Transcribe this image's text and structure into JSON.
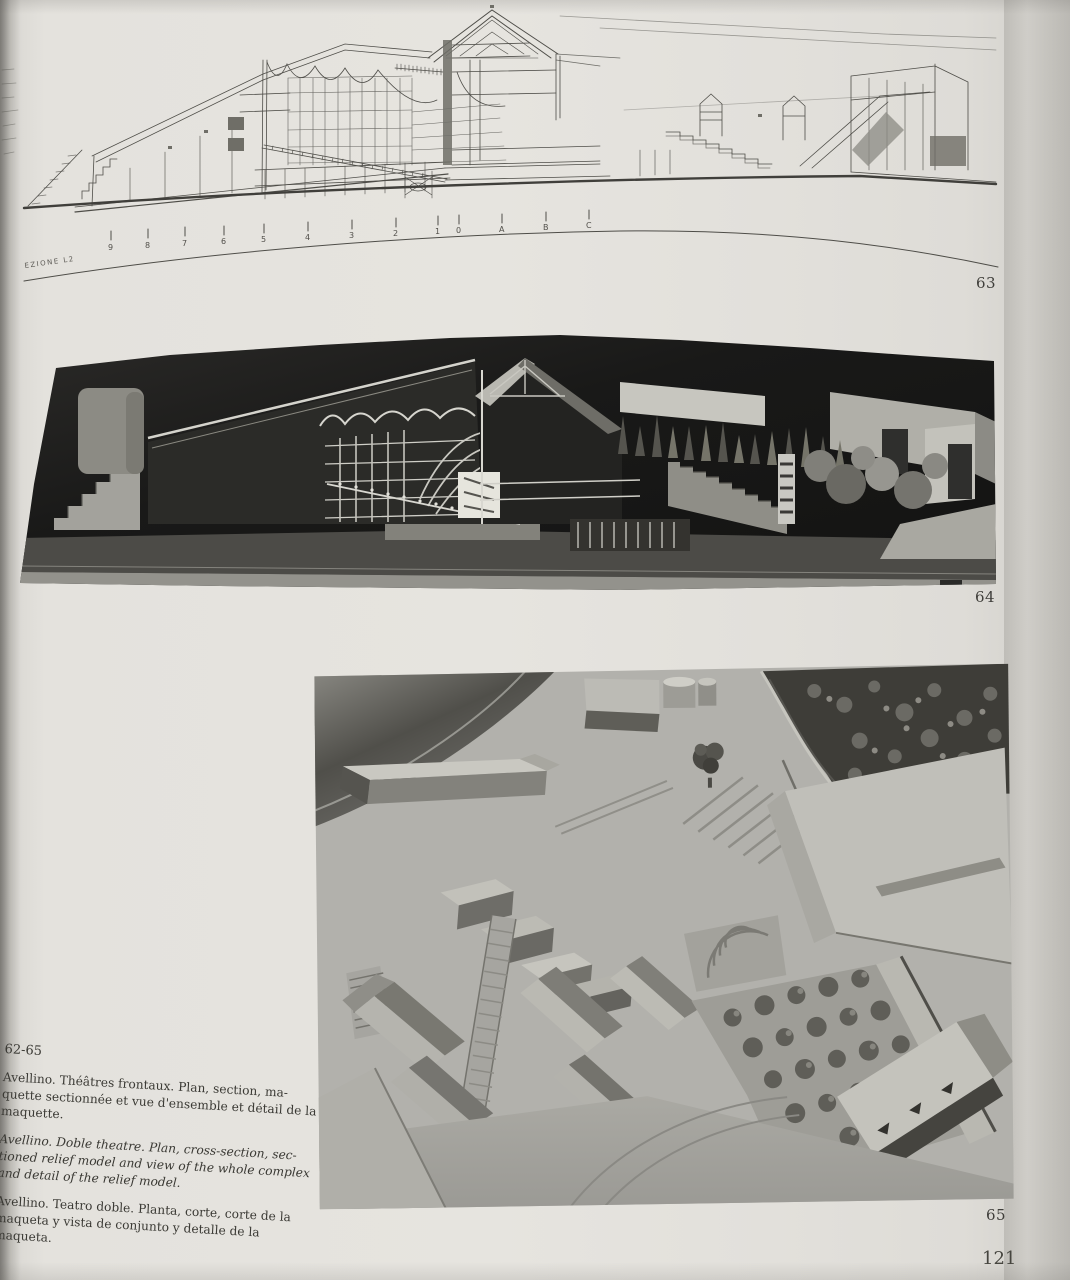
{
  "figures": {
    "fig63": "63",
    "fig64": "64",
    "fig65": "65"
  },
  "page_number": "121",
  "drawing": {
    "section_label": "EZIONE  L2",
    "scale_labels": [
      "9",
      "8",
      "7",
      "6",
      "5",
      "4",
      "3",
      "2",
      "1",
      "0",
      "A",
      "B",
      "C"
    ]
  },
  "captions": {
    "range": "62-65",
    "french": [
      "Avellino. Théâtres frontaux. Plan, section, ma-",
      "quette sectionnée et vue d'ensemble et détail de la",
      "maquette."
    ],
    "english": [
      "Avellino. Doble theatre. Plan, cross-section, sec-",
      "tioned relief model and view of the whole complex",
      "and detail of the relief model."
    ],
    "spanish": [
      "Avellino. Teatro doble. Planta, corte, corte de la",
      "maqueta y vista de conjunto y detalle de la",
      "maqueta."
    ]
  },
  "colors": {
    "paper": "#e4e2dd",
    "ink_line": "#4e4d48",
    "photo64_background": "#1a1a18",
    "model_light": "#c7c6bf",
    "model_mid": "#8f8e88",
    "model_dark": "#3a3935",
    "photo65_base": "#b2b1ac"
  }
}
